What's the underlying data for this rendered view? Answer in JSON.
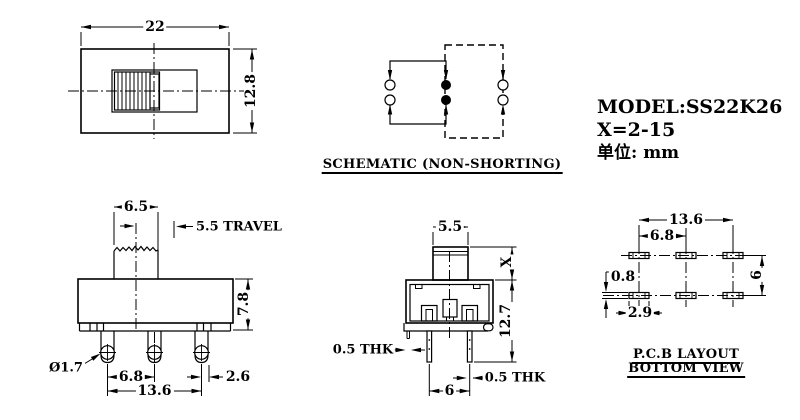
{
  "title_block": {
    "model": "MODEL:SS22K26",
    "x_range": "X=2-15",
    "unit": "单位: mm"
  },
  "top_view": {
    "dim_width": "22",
    "dim_height": "12.8"
  },
  "schematic": {
    "label": "SCHEMATIC (NON-SHORTING)"
  },
  "front_view": {
    "dim_knob_width": "6.5",
    "dim_travel": "5.5 TRAVEL",
    "dim_body_height": "7.8",
    "dim_hole_dia": "Ø1.7",
    "dim_pin_pitch": "6.8",
    "dim_pin_span": "13.6",
    "dim_pin_width": "2.6"
  },
  "side_view": {
    "dim_knob_width": "5.5",
    "dim_knob_height": "X",
    "dim_total_height": "12.7",
    "dim_plate_thickness": "0.5 THK",
    "dim_pin_thickness": "0.5 THK",
    "dim_pin_pitch": "6"
  },
  "pcb_layout": {
    "title_line1": "P.C.B LAYOUT",
    "title_line2": "BOTTOM VIEW",
    "dim_span": "13.6",
    "dim_pitch": "6.8",
    "dim_pad_height": "0.8",
    "dim_pad_width": "2.9",
    "dim_row_gap": "6"
  },
  "colors": {
    "line": "#000000",
    "background": "#ffffff"
  }
}
